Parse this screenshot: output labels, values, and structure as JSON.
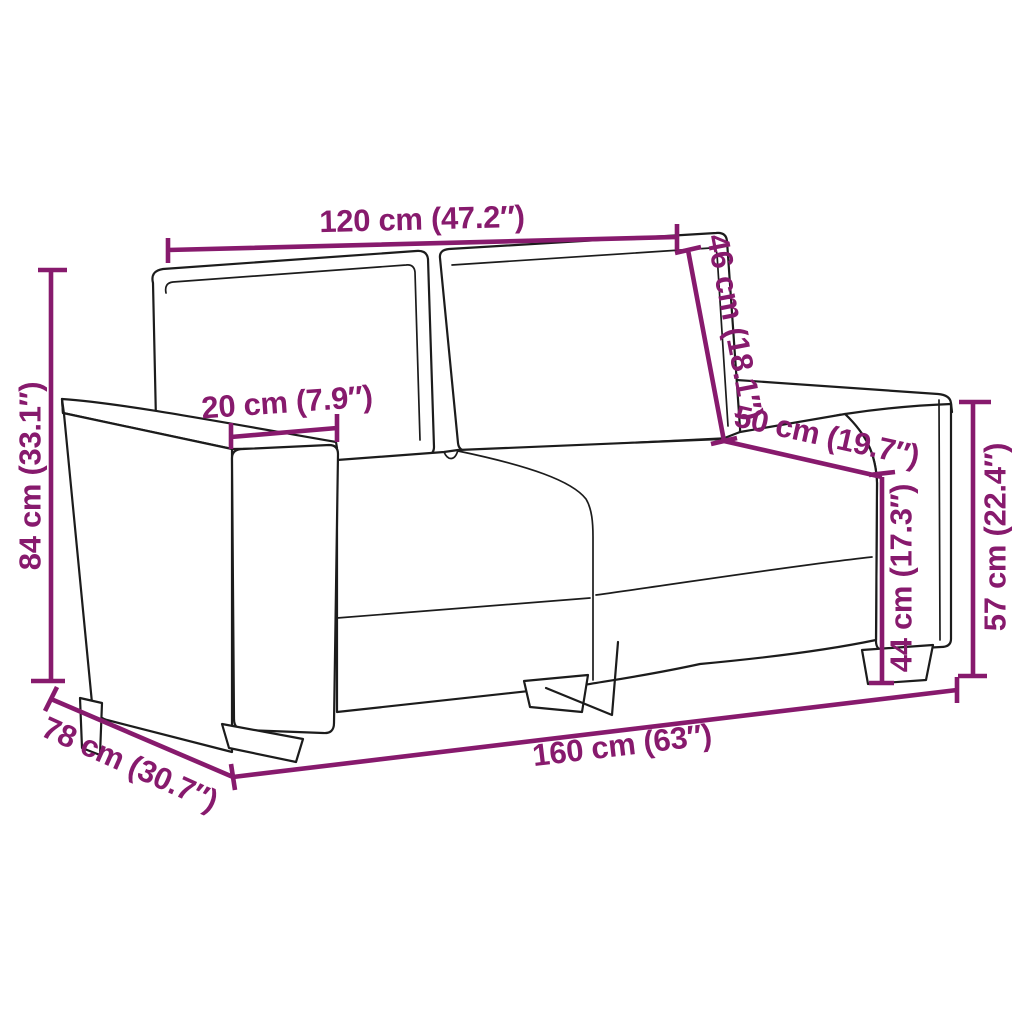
{
  "diagram": {
    "title": "sofa-dimension-diagram",
    "subject": "2-seater sofa line drawing with measurements",
    "accent_color": "#871a6d",
    "outline_color": "#1c1c1c",
    "background_color": "#ffffff",
    "dimensions": {
      "back_width": {
        "label": "120 cm (47.2″)",
        "cm": "120",
        "inches": "47.2"
      },
      "backrest_height": {
        "label": "46 cm (18.1″)",
        "cm": "46",
        "inches": "18.1"
      },
      "armrest_width": {
        "label": "20 cm (7.9″)",
        "cm": "20",
        "inches": "7.9"
      },
      "seat_depth": {
        "label": "50 cm (19.7″)",
        "cm": "50",
        "inches": "19.7"
      },
      "overall_height": {
        "label": "84 cm (33.1″)",
        "cm": "84",
        "inches": "33.1"
      },
      "seat_height": {
        "label": "44 cm (17.3″)",
        "cm": "44",
        "inches": "17.3"
      },
      "armrest_height": {
        "label": "57 cm (22.4″)",
        "cm": "57",
        "inches": "22.4"
      },
      "overall_depth": {
        "label": "78 cm (30.7″)",
        "cm": "78",
        "inches": "30.7"
      },
      "overall_width": {
        "label": "160 cm (63″)",
        "cm": "160",
        "inches": "63"
      }
    }
  }
}
